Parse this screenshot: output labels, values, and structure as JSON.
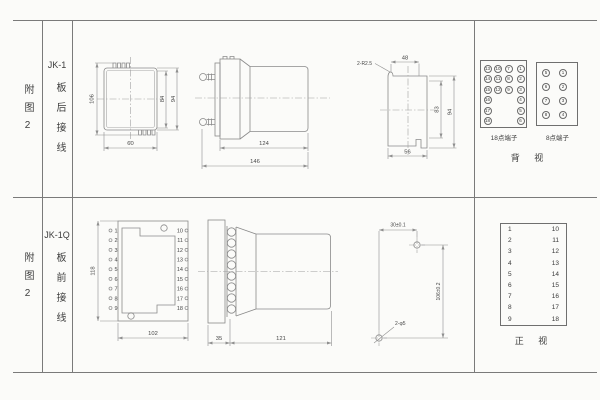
{
  "table": {
    "row1": {
      "figure": "附图2",
      "model": "JK-1",
      "wiring": "板后接线"
    },
    "row2": {
      "figure": "附图2",
      "model": "JK-1Q",
      "wiring": "板前接线"
    }
  },
  "top_row": {
    "rear_outline": {
      "overall_height": "106",
      "inner_height": "84",
      "body_height": "94",
      "width": "60"
    },
    "side_view": {
      "body_length": "124",
      "overall_length": "146"
    },
    "panel_cutout": {
      "corner_radius": "2-R2.5",
      "top_offset": "48",
      "inner_height": "83",
      "height": "94",
      "width": "56"
    },
    "terminals18": {
      "label": "18点端子",
      "rows": [
        [
          "13",
          "10",
          "7",
          "1"
        ],
        [
          "14",
          "11",
          "8",
          "2"
        ],
        [
          "15",
          "12",
          "9",
          "3"
        ],
        [
          "16",
          "",
          "",
          "4"
        ],
        [
          "17",
          "",
          "",
          "5"
        ],
        [
          "18",
          "",
          "",
          "6"
        ]
      ]
    },
    "terminals8": {
      "label": "8点端子",
      "rows": [
        [
          "5",
          "1"
        ],
        [
          "6",
          "2"
        ],
        [
          "7",
          "3"
        ],
        [
          "8",
          "4"
        ]
      ]
    },
    "view_label": "背 视"
  },
  "bottom_row": {
    "front_view": {
      "height": "118",
      "width": "102",
      "left_terminals": [
        "1",
        "2",
        "3",
        "4",
        "5",
        "6",
        "7",
        "8",
        "9"
      ],
      "right_terminals": [
        "10",
        "11",
        "12",
        "13",
        "14",
        "15",
        "16",
        "17",
        "18"
      ]
    },
    "side_view": {
      "panel_depth": "35",
      "body_length": "121"
    },
    "drill_plan": {
      "hole_spacing_h": "30±0.1",
      "hole_spacing_v": "106±0.2",
      "hole_note": "2-φ5"
    },
    "terminal_table": {
      "left": [
        "1",
        "2",
        "3",
        "4",
        "5",
        "6",
        "7",
        "8",
        "9"
      ],
      "right": [
        "10",
        "11",
        "12",
        "13",
        "14",
        "15",
        "16",
        "17",
        "18"
      ]
    },
    "view_label": "正 视"
  }
}
